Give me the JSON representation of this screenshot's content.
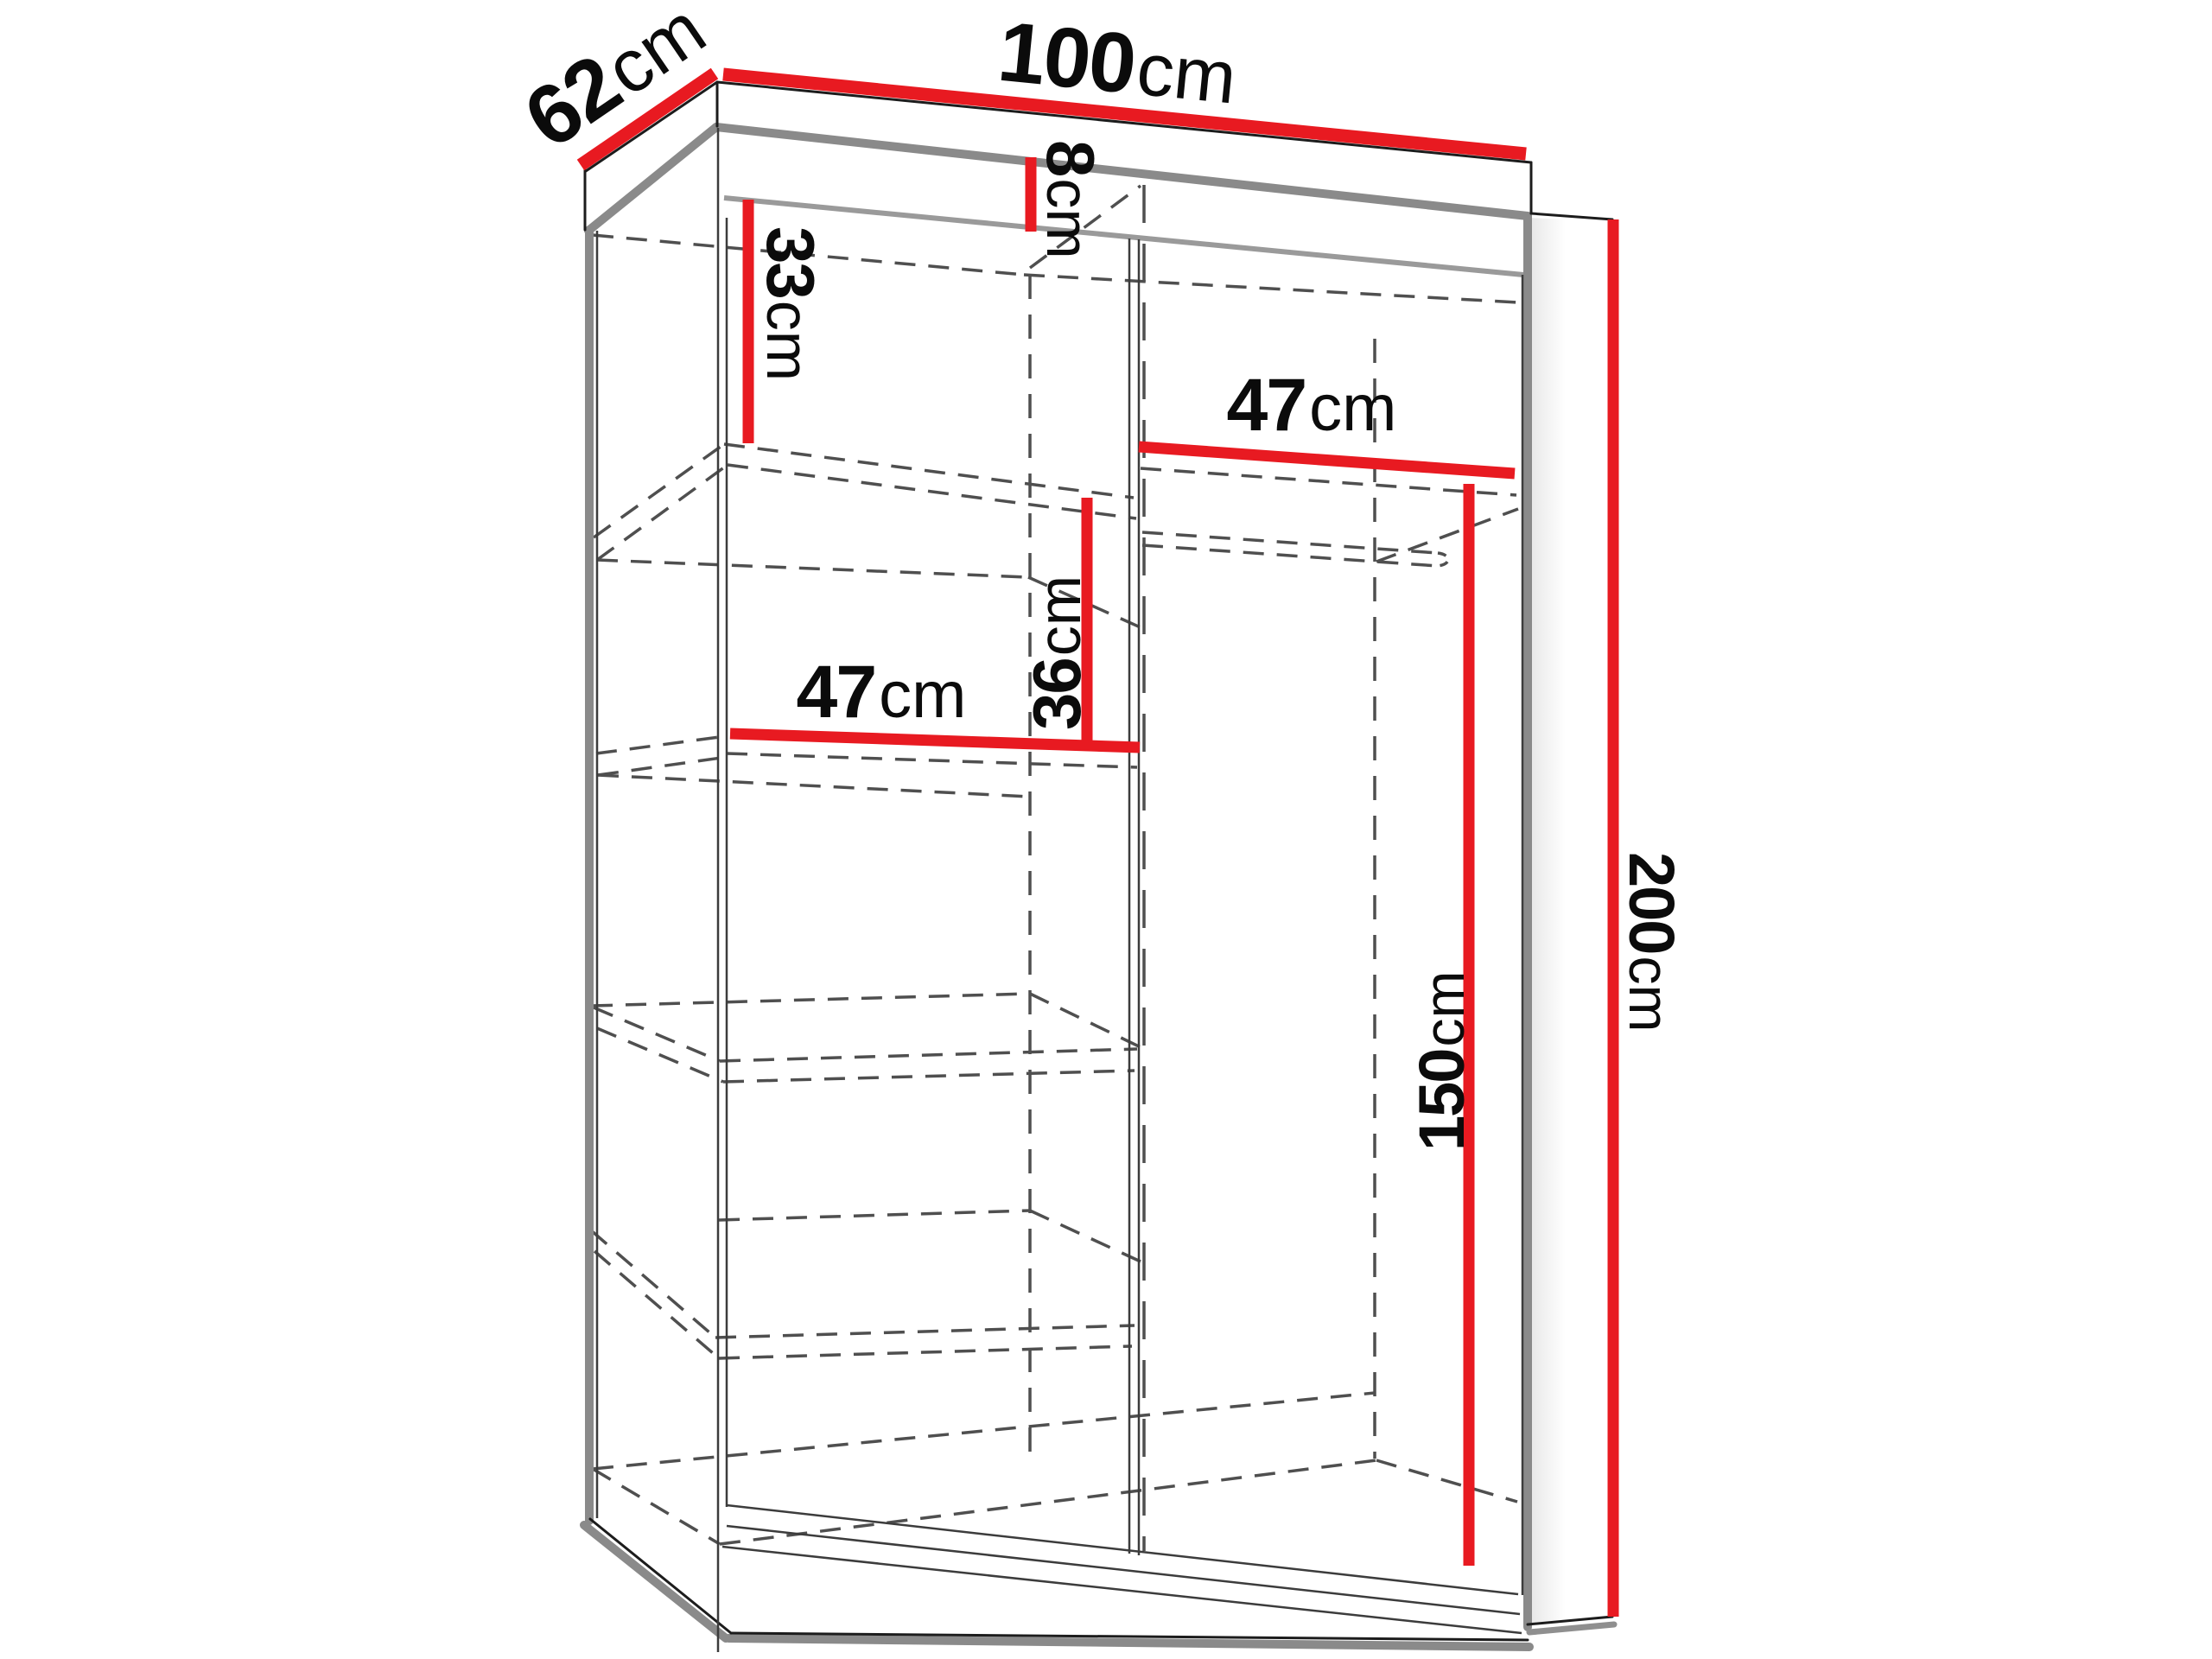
{
  "diagram": {
    "type": "wardrobe-dimension-diagram",
    "unit": "cm",
    "dimensions": {
      "width": {
        "value": "100",
        "unit": "cm"
      },
      "depth": {
        "value": "62",
        "unit": "cm"
      },
      "height": {
        "value": "200",
        "unit": "cm"
      },
      "top_gap": {
        "value": "8",
        "unit": "cm"
      },
      "upper_compartment_height": {
        "value": "33",
        "unit": "cm"
      },
      "shelf_spacing": {
        "value": "36",
        "unit": "cm"
      },
      "left_shelf_width": {
        "value": "47",
        "unit": "cm"
      },
      "right_shelf_width": {
        "value": "47",
        "unit": "cm"
      },
      "hanging_space_height": {
        "value": "150",
        "unit": "cm"
      }
    },
    "colors": {
      "dimension": "#e81a21",
      "edges": "#1c1c1c",
      "shadow": "#8a8a8a",
      "hidden": "#4f4f4f",
      "background": "#ffffff"
    }
  }
}
